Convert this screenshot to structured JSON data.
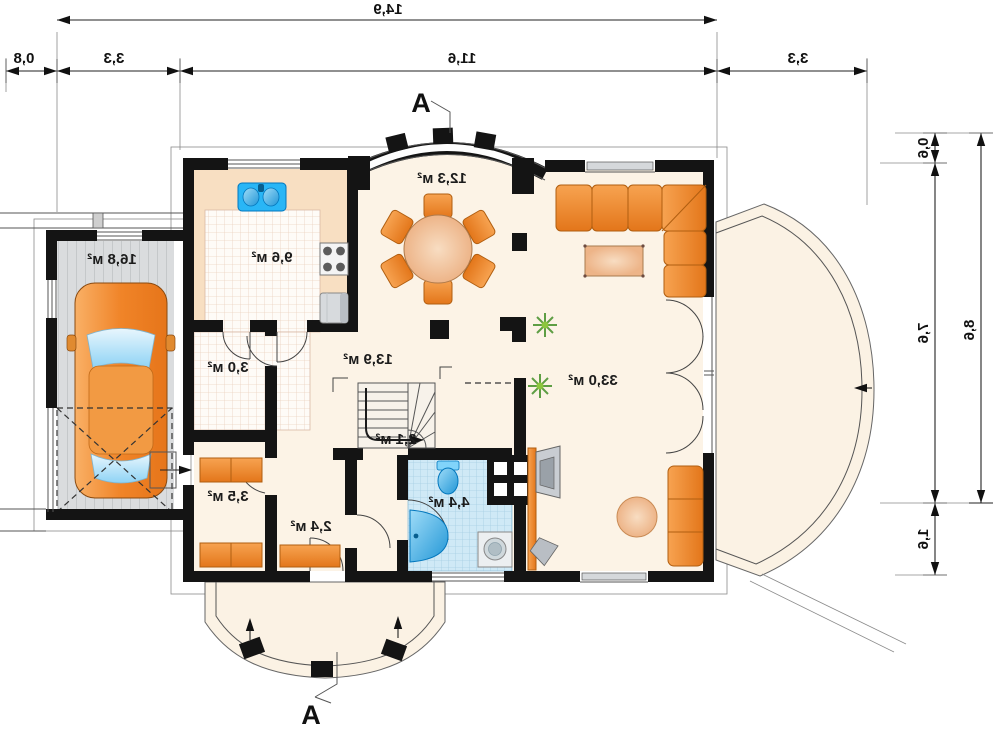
{
  "plan": {
    "section_label": "A",
    "rooms": {
      "garage": "16,8 м²",
      "kitchen": "9,6 м²",
      "wc": "3,0 м²",
      "dining": "12,3 м²",
      "hall": "13,9 м²",
      "stairs": "2,1 м²",
      "storage": "3,5 м²",
      "corridor": "2,4 м²",
      "bathroom": "4,4 м²",
      "living": "33,0 м²"
    },
    "dimensions": {
      "top_total": "14,9",
      "top_segments": [
        "0,8",
        "3,3",
        "11,6",
        "3,3"
      ],
      "right_total": "8,6",
      "right_segments": [
        "0,6",
        "7,6",
        "1,6"
      ]
    },
    "colors": {
      "wall": "#141414",
      "floor_cream": "#fcf3e6",
      "kitchen_peach": "#f8dfc2",
      "furniture_orange": "#ef8a2c",
      "bathroom_blue": "#cfe9f6",
      "fixture_blue": "#45b8ec",
      "garage_gray": "#d9dbdd",
      "plant_green": "#68a04c"
    }
  }
}
